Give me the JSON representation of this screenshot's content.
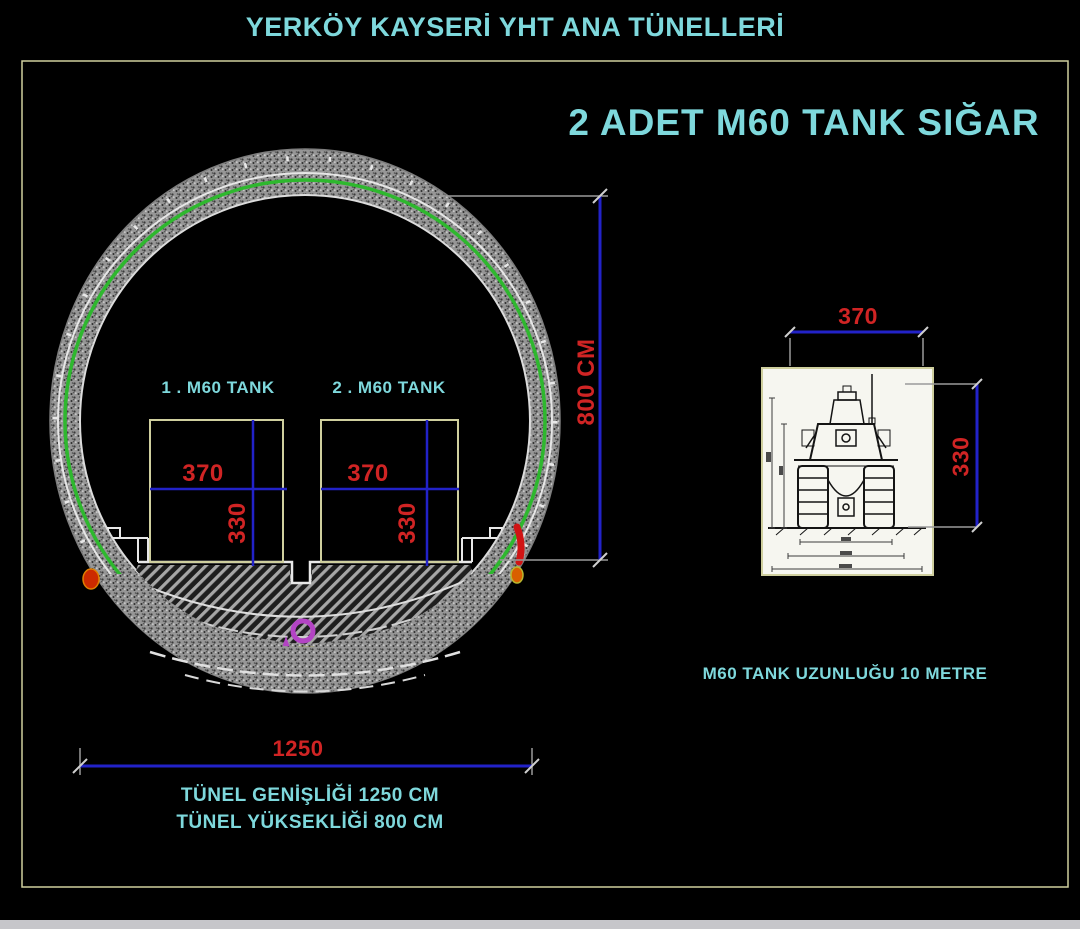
{
  "title": "YERKÖY KAYSERİ YHT ANA TÜNELLERİ",
  "headline": "2 ADET M60 TANK SIĞAR",
  "tunnel_section": {
    "tanks": [
      {
        "label": "1 . M60 TANK",
        "width": "370",
        "height": "330"
      },
      {
        "label": "2 . M60 TANK",
        "width": "370",
        "height": "330"
      }
    ],
    "height_dim_label": "800 CM",
    "width_dim_label": "1250",
    "notes": [
      "TÜNEL GENİŞLİĞİ 1250 CM",
      "TÜNEL YÜKSEKLİĞİ 800 CM"
    ]
  },
  "tank_front_view": {
    "width_dim_label": "370",
    "height_dim_label": "330",
    "caption": "M60 TANK UZUNLUĞU 10 METRE"
  },
  "colors": {
    "background": "#000000",
    "text_cyan": "#7ed8dc",
    "dim_red": "#d02424",
    "dim_blue": "#2222c8",
    "frame_khaki": "#cfcf9e",
    "lining_green": "#2eb82e",
    "marker_magenta": "#b344c4",
    "hazard_orange": "#d96000",
    "hazard_red": "#d01414",
    "hazard_yellow": "#c8c832",
    "concrete_gray": "#969696"
  }
}
